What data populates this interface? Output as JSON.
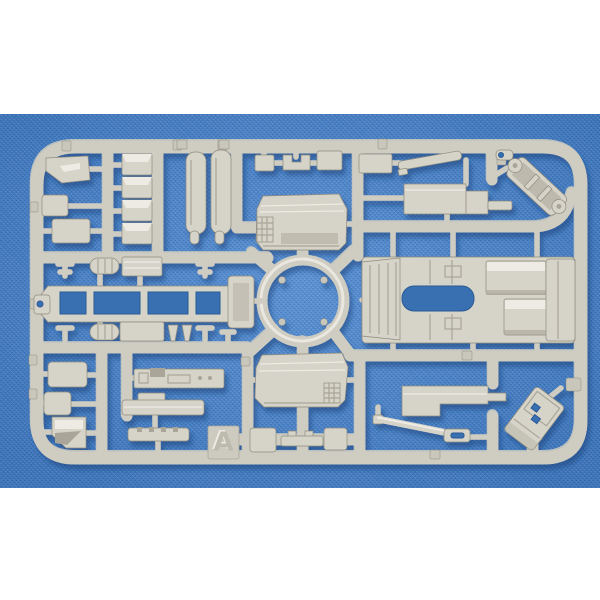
{
  "sprue": {
    "label": "A"
  },
  "colors": {
    "backdrop": "#ffffff",
    "fabric_blue": "#4181cd",
    "fabric_blue_light": "#6ba3de",
    "fabric_blue_dark": "#2d63a8",
    "plastic": "#d6d3c8",
    "plastic_light": "#edebe4",
    "plastic_dark": "#a9a598",
    "plastic_edge": "#8f8b7e",
    "plastic_runner": "#cfccc1",
    "plastic_tab": "#c9c6bb",
    "hole_blue": "#376fb2",
    "shadow_blue": "#153d75"
  },
  "parts": [
    "mudflap",
    "small stowage box",
    "stowage box",
    "wedge block x4",
    "seat cushion x2",
    "cab hood upper half",
    "cab hood lower half",
    "fuel tank",
    "diagonal frame bracket",
    "radiator ladder bracket",
    "chassis ladder frame",
    "air tanks",
    "dashboard",
    "sill step",
    "slotted bumper",
    "interior floor pan",
    "seat boxes",
    "stepped fender plate",
    "tow rod",
    "rear door hatch",
    "letter tab A"
  ]
}
